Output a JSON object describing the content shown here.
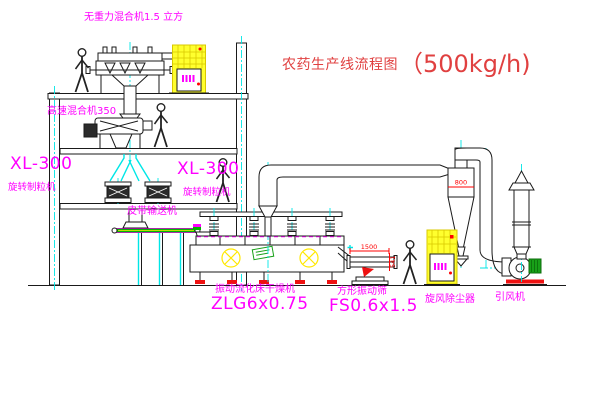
{
  "title": {
    "name": "农药生产线流程图",
    "capacity": "（500kg/h)"
  },
  "labels": {
    "gravity_mixer": "无重力混合机1.5 立方",
    "high_speed_mixer": "高速混合机350",
    "granulator_left_model": "XL-300",
    "granulator_left_name": "旋转制粒机",
    "granulator_mid_model": "XL-300",
    "granulator_mid_name": "旋转制粒机",
    "belt_conveyor": "皮带输送机",
    "dryer_name": "振动流化床干燥机",
    "dryer_model": "ZLG6x0.75",
    "screen_name": "方形振动筛",
    "screen_model": "FS0.6x1.5",
    "cyclone": "旋风除尘器",
    "fan": "引风机"
  },
  "dimensions": {
    "cyclone_width": "800",
    "screen_length": "1500",
    "screen_height": "541"
  },
  "colors": {
    "label": "#ff00ff",
    "title": "#e04040",
    "dimension": "#ff0000",
    "centerline": "#00e6e6",
    "cabinet": "#ffff2e",
    "cabinet_hatch": "#d9c900",
    "line": "#1a1a1a",
    "motor": "#18a018",
    "conveyor": "#00b400",
    "foot": "#ee1111"
  }
}
